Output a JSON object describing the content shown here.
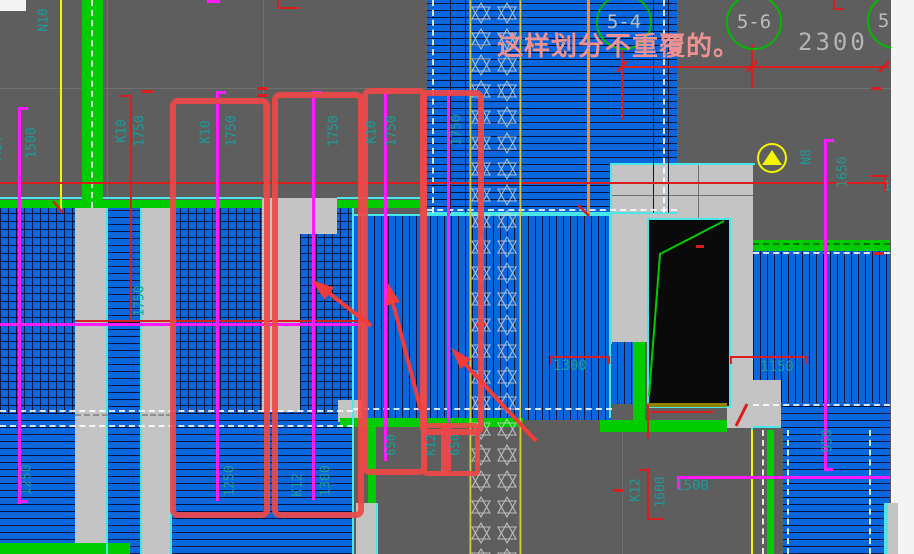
{
  "annotation": {
    "text": "这样划分不重覆的。"
  },
  "top": {
    "dim_2300": "2300",
    "bubbles": [
      "5-4",
      "5-6",
      "5-8"
    ]
  },
  "colors": {
    "background": "#5e5e5e",
    "slab_blue": "#0a66dd",
    "wall_gray": "#c4c4c4",
    "beam_green": "#00cc00",
    "edge_cyan": "#49e8e8",
    "annotation_red": "#ef4848",
    "line_red": "#d81e1e",
    "rebar_magenta": "#ff1aff",
    "axis_yellow": "#f5f500",
    "text_teal": "#1d9b9b",
    "note_salmon": "#ef9191"
  },
  "labels": [
    {
      "text": "N10",
      "x": 44,
      "y": 20,
      "rot": -90,
      "size": 13
    },
    {
      "text": "M14",
      "x": -2,
      "y": 148,
      "rot": -90,
      "size": 13
    },
    {
      "text": "1500",
      "x": 32,
      "y": 143,
      "rot": -90,
      "size": 13
    },
    {
      "text": "K10",
      "x": 122,
      "y": 131,
      "rot": -90,
      "size": 13
    },
    {
      "text": "1750",
      "x": 140,
      "y": 131,
      "rot": -90,
      "size": 13
    },
    {
      "text": "K10",
      "x": 206,
      "y": 132,
      "rot": -90,
      "size": 13
    },
    {
      "text": "1750",
      "x": 232,
      "y": 131,
      "rot": -90,
      "size": 13
    },
    {
      "text": "1750",
      "x": 334,
      "y": 131,
      "rot": -90,
      "size": 13
    },
    {
      "text": "K10",
      "x": 372,
      "y": 132,
      "rot": -90,
      "size": 13
    },
    {
      "text": "1750",
      "x": 392,
      "y": 131,
      "rot": -90,
      "size": 13
    },
    {
      "text": "1750",
      "x": 457,
      "y": 130,
      "rot": -90,
      "size": 13
    },
    {
      "text": "1750",
      "x": 140,
      "y": 301,
      "rot": -90,
      "size": 13
    },
    {
      "text": "1250",
      "x": 27,
      "y": 480,
      "rot": -90,
      "size": 13
    },
    {
      "text": "1250",
      "x": 230,
      "y": 481,
      "rot": -90,
      "size": 13
    },
    {
      "text": "K12",
      "x": 298,
      "y": 485,
      "rot": -90,
      "size": 13
    },
    {
      "text": "1300",
      "x": 326,
      "y": 481,
      "rot": -90,
      "size": 13
    },
    {
      "text": "650",
      "x": 391,
      "y": 445,
      "rot": -90,
      "size": 12
    },
    {
      "text": "K12",
      "x": 431,
      "y": 445,
      "rot": -90,
      "size": 12
    },
    {
      "text": "650",
      "x": 455,
      "y": 445,
      "rot": -90,
      "size": 12
    },
    {
      "text": "1300",
      "x": 570,
      "y": 366,
      "rot": 0,
      "size": 14
    },
    {
      "text": "1150",
      "x": 777,
      "y": 367,
      "rot": 0,
      "size": 14
    },
    {
      "text": "N8",
      "x": 807,
      "y": 157,
      "rot": -90,
      "size": 13
    },
    {
      "text": "1650",
      "x": 843,
      "y": 172,
      "rot": -90,
      "size": 13
    },
    {
      "text": "950",
      "x": 828,
      "y": 441,
      "rot": -90,
      "size": 13
    },
    {
      "text": "K12",
      "x": 636,
      "y": 490,
      "rot": -90,
      "size": 13
    },
    {
      "text": "1600",
      "x": 661,
      "y": 492,
      "rot": -90,
      "size": 13
    },
    {
      "text": "1500",
      "x": 692,
      "y": 486,
      "rot": 0,
      "size": 14
    },
    {
      "text": "1750",
      "x": 899,
      "y": 187,
      "rot": 0,
      "size": 13
    }
  ]
}
